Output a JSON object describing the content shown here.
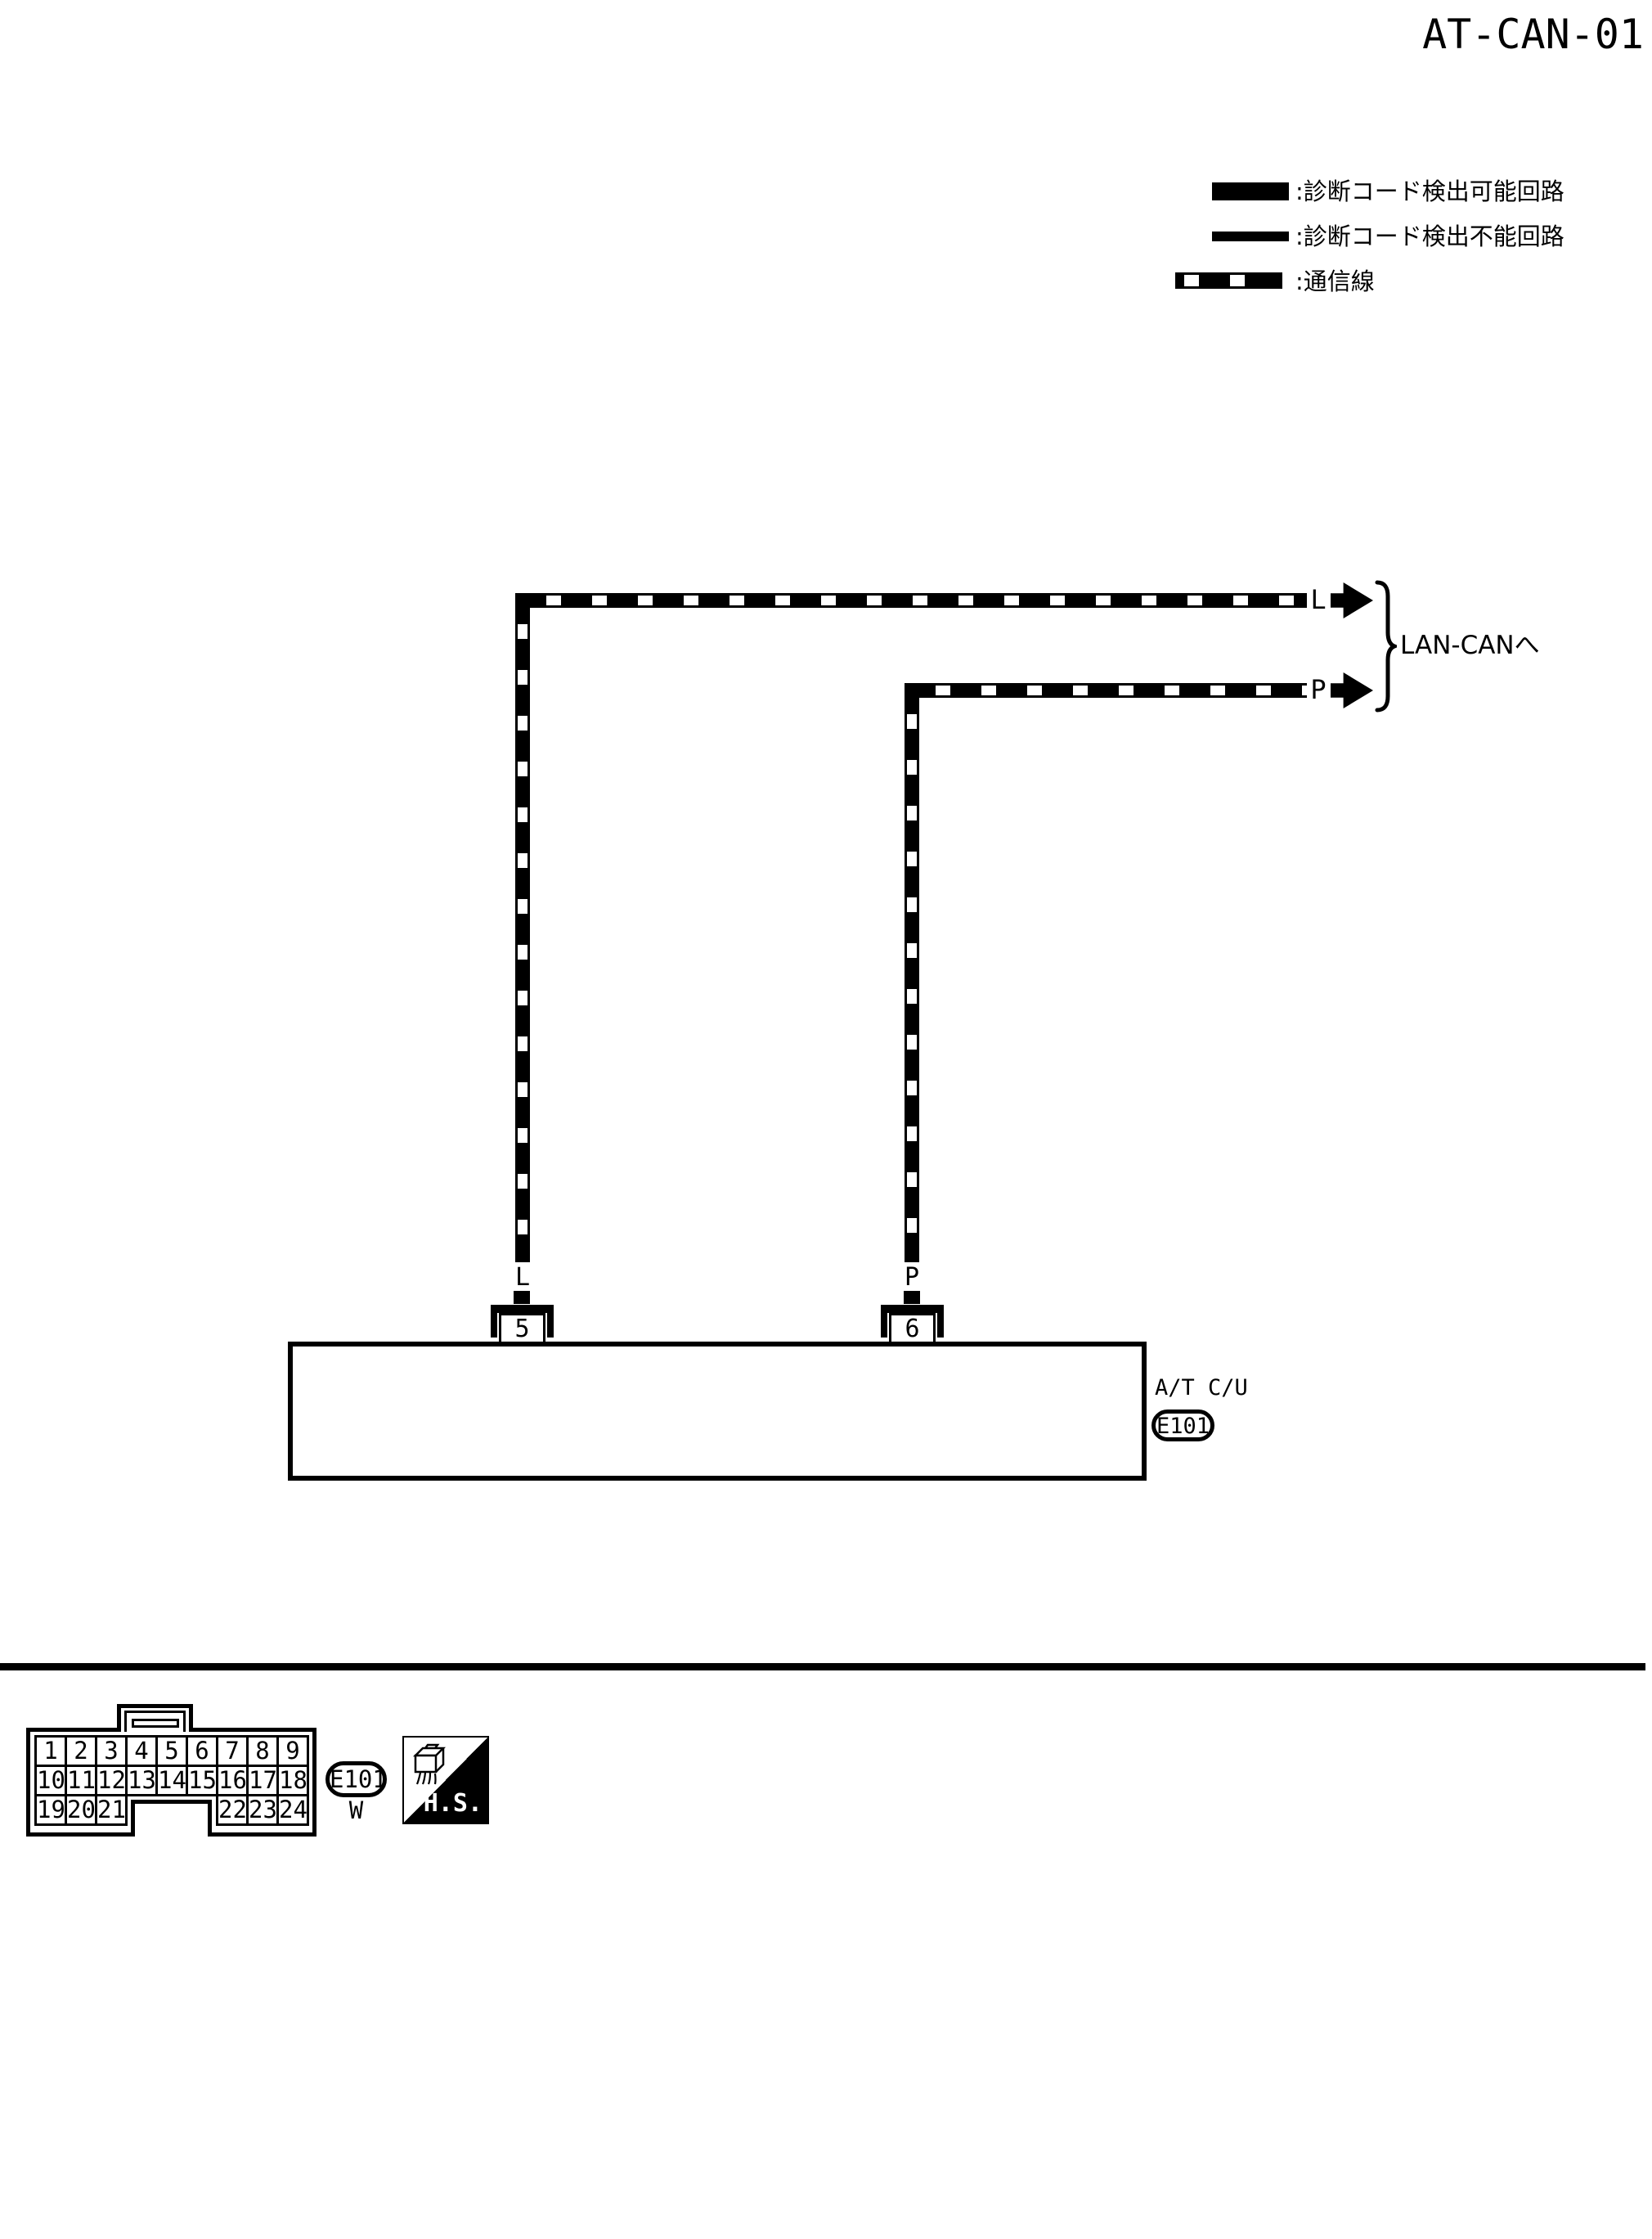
{
  "page": {
    "title": "AT-CAN-01"
  },
  "legend": {
    "detectable": ":診断コード検出可能回路",
    "undetectable": ":診断コード検出不能回路",
    "comm_line": ":通信線"
  },
  "diagram": {
    "destination_label": "LAN-CANへ",
    "wire_l": {
      "end_label": "L",
      "drop_label": "L"
    },
    "wire_p": {
      "end_label": "P",
      "drop_label": "P"
    },
    "pin5": {
      "number": "5",
      "signal": "CAN H"
    },
    "pin6": {
      "number": "6",
      "signal": "CAN L"
    },
    "component": {
      "name": "A/T C/U",
      "connector": "E101"
    }
  },
  "footer": {
    "connector_id": "E101",
    "connector_color": "W",
    "stamp": "H.S.",
    "pins": [
      "1",
      "2",
      "3",
      "4",
      "5",
      "6",
      "7",
      "8",
      "9",
      "10",
      "11",
      "12",
      "13",
      "14",
      "15",
      "16",
      "17",
      "18",
      "19",
      "20",
      "21",
      "22",
      "23",
      "24"
    ]
  },
  "colors": {
    "ink": "#000000",
    "paper": "#ffffff"
  }
}
